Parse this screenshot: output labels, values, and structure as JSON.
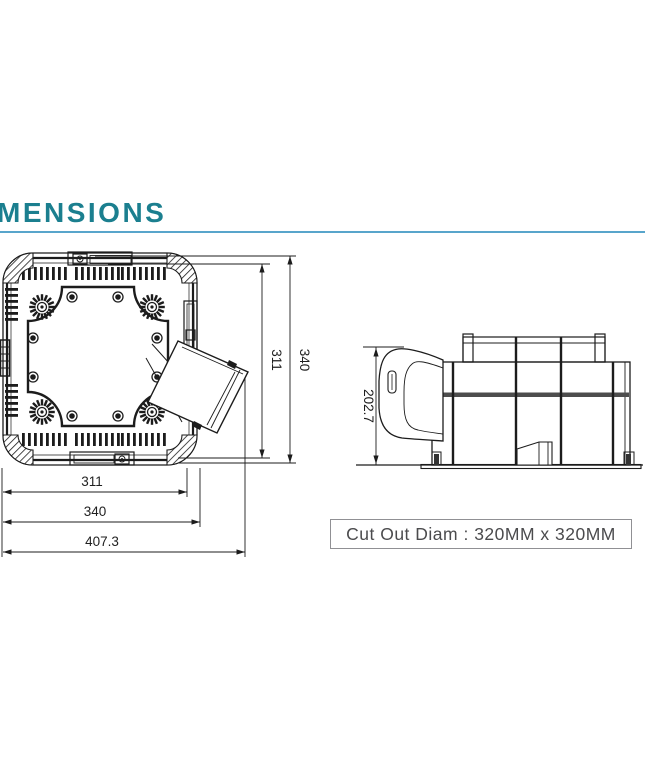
{
  "header": {
    "title": "MENSIONS"
  },
  "top_view": {
    "dim_height_inner": "311",
    "dim_height_outer": "340",
    "dim_width_inner": "311",
    "dim_width_outer": "340",
    "dim_width_overall": "407.3"
  },
  "side_view": {
    "dim_height": "202.7"
  },
  "note": {
    "cutout_label": "Cut Out Diam : 320MM x 320MM"
  },
  "colors": {
    "title_teal": "#1B7F8F",
    "rule_blue": "#58A5CB",
    "drawing_line": "#1C1C1C",
    "note_text": "#4B4B4D",
    "note_border": "#909094"
  }
}
